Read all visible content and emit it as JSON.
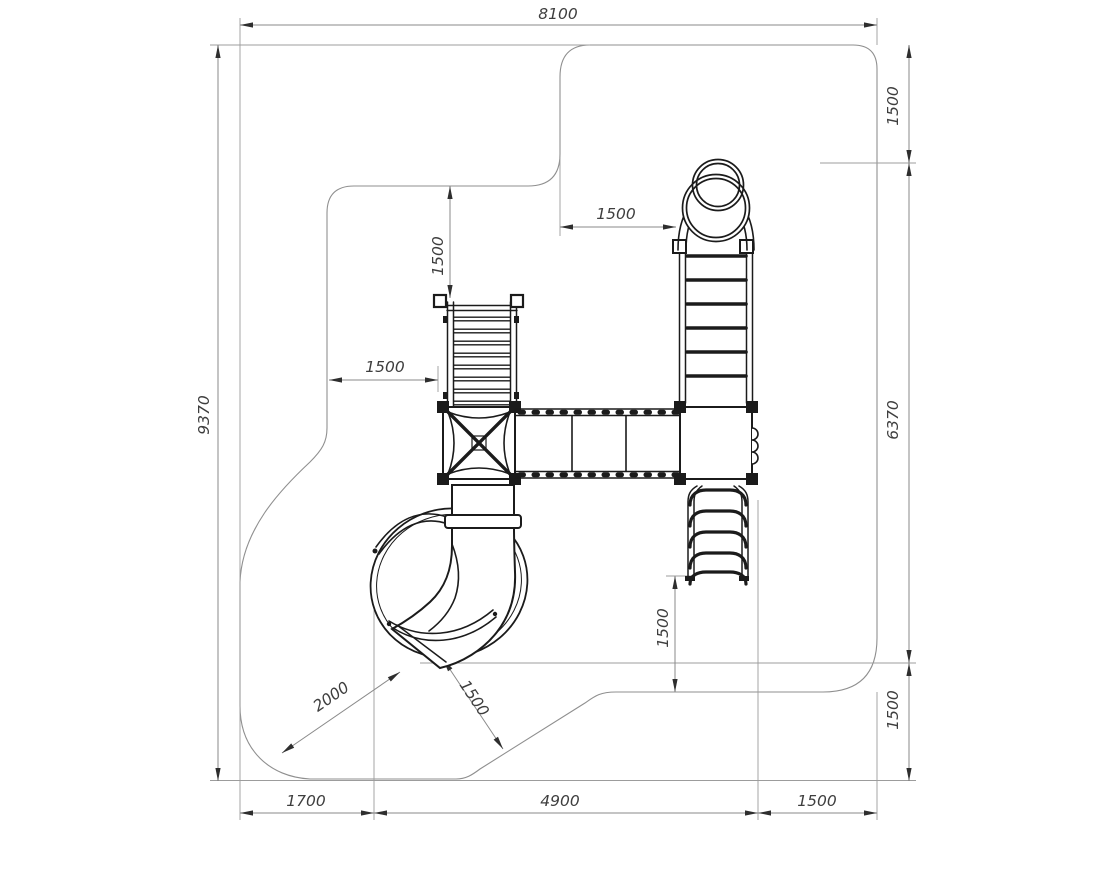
{
  "title": "Playground equipment safety-zone plan",
  "colors": {
    "background": "#ffffff",
    "outline_gray": "#8f8f8f",
    "dimension_gray": "#8a8a8a",
    "equipment_black": "#1b1b1b",
    "text_gray": "#3e3e3e"
  },
  "dims": {
    "overall_width": "8100",
    "overall_height": "9370",
    "right_chain": [
      "1500",
      "6370",
      "1500"
    ],
    "bottom_chain": [
      "1700",
      "4900",
      "1500"
    ],
    "stairs_top_clearance": "1500",
    "stairs_side_clearance": "1500",
    "ladder_top_clearance": "1500",
    "ladder_bottom_clearance": "1500",
    "slide_exit_clearance": "2000",
    "slide_side_clearance": "1500"
  }
}
